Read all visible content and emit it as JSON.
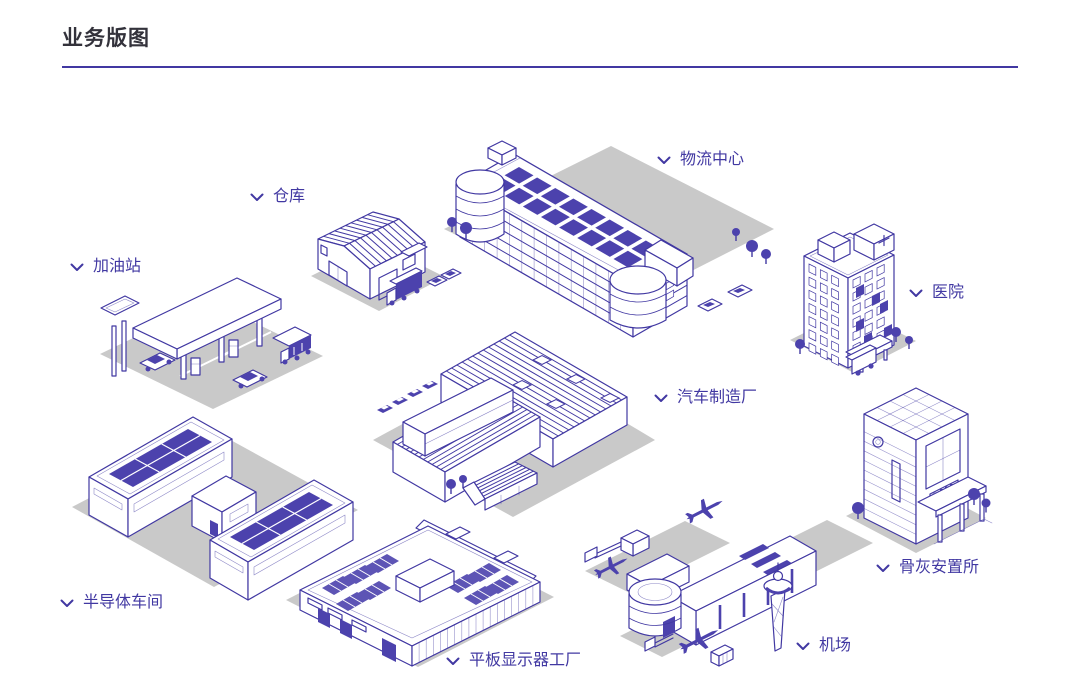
{
  "page": {
    "title": "业务版图"
  },
  "map": {
    "items": [
      {
        "id": "warehouse",
        "label": "仓库"
      },
      {
        "id": "logistics-center",
        "label": "物流中心"
      },
      {
        "id": "gas-station",
        "label": "加油站"
      },
      {
        "id": "hospital",
        "label": "医院"
      },
      {
        "id": "auto-factory",
        "label": "汽车制造厂"
      },
      {
        "id": "semiconductor-workshop",
        "label": "半导体车间"
      },
      {
        "id": "display-factory",
        "label": "平板显示器工厂"
      },
      {
        "id": "airport",
        "label": "机场"
      },
      {
        "id": "columbarium",
        "label": "骨灰安置所"
      }
    ]
  },
  "icons": {
    "label_marker": "chevron-down"
  },
  "colors": {
    "accent": "#4138A2",
    "panel_fill": "#4C42AD",
    "shadow": "#C9C9C9",
    "title_text": "#33323B",
    "background": "#FFFFFF"
  }
}
